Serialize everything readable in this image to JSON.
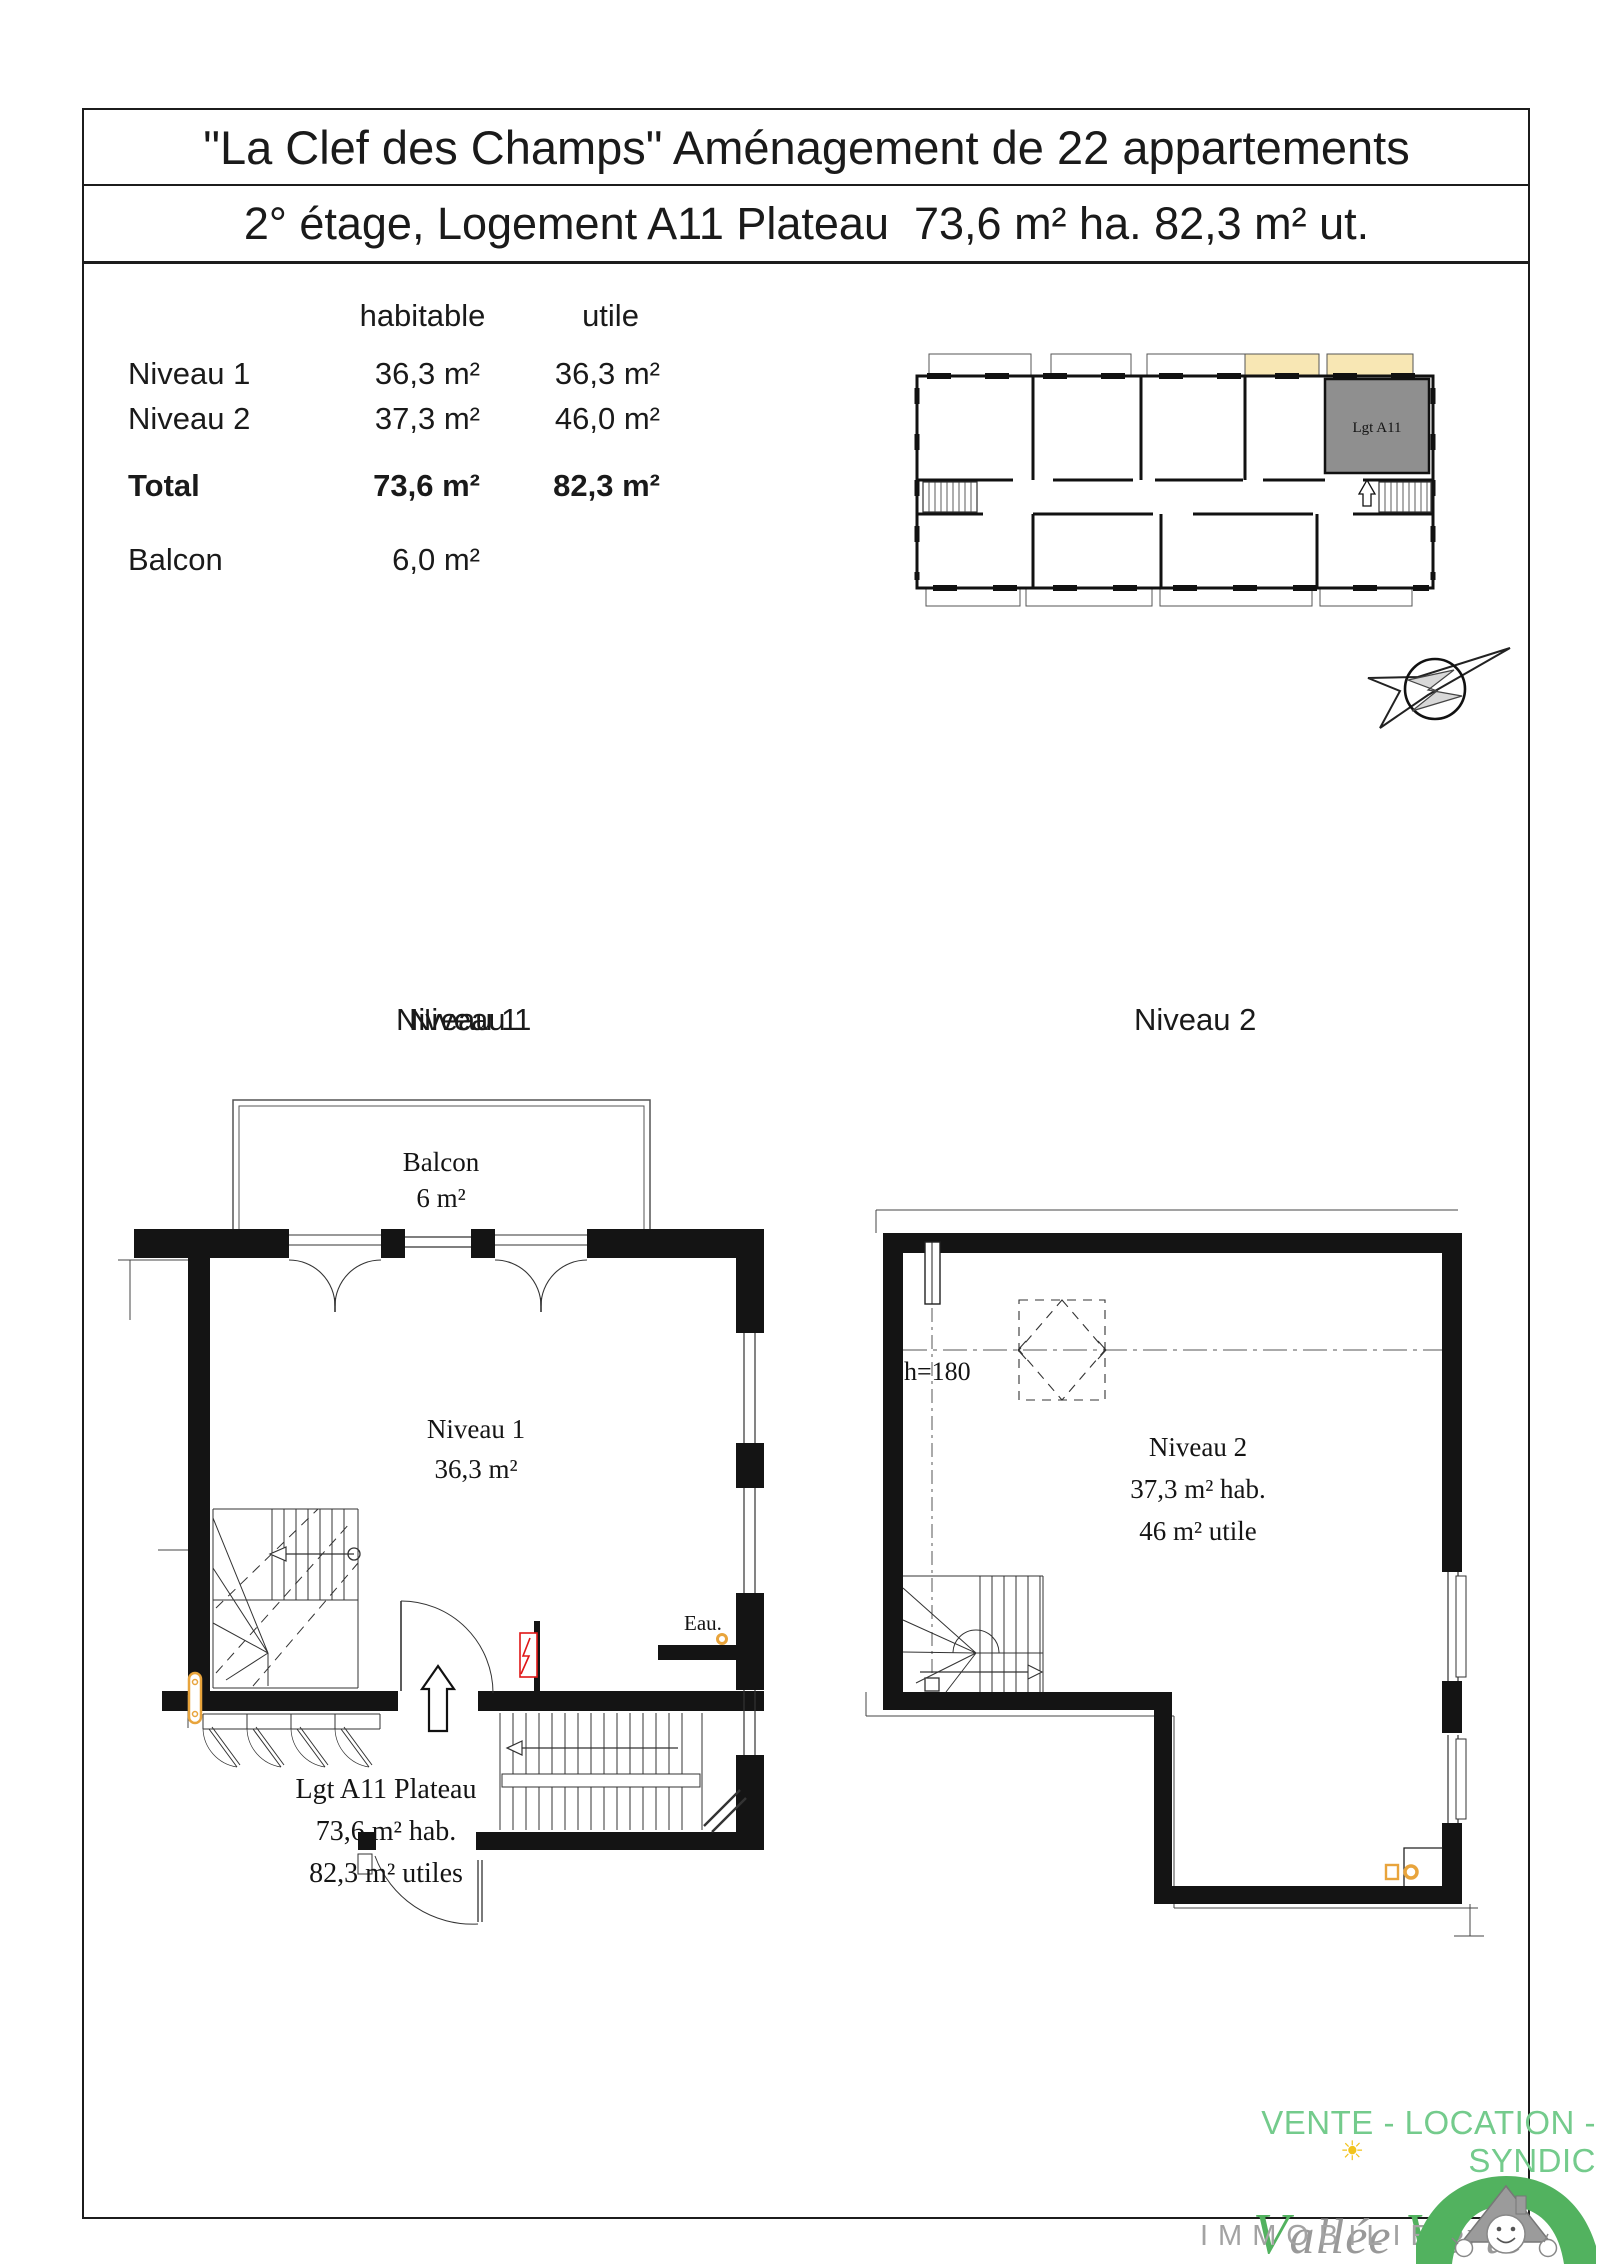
{
  "title": {
    "line1": "\"La Clef des Champs\" Aménagement de 22 appartements",
    "line2": "2° étage, Logement A11 Plateau  73,6 m² ha. 82,3 m² ut."
  },
  "area_table": {
    "header": {
      "habitable": "habitable",
      "utile": "utile"
    },
    "rows": [
      {
        "label": "Niveau 1",
        "habitable": "36,3 m²",
        "utile": "36,3 m²"
      },
      {
        "label": "Niveau 2",
        "habitable": "37,3 m²",
        "utile": "46,0 m²"
      }
    ],
    "total": {
      "label": "Total",
      "habitable": "73,6 m²",
      "utile": "82,3 m²"
    },
    "balcon": {
      "label": "Balcon",
      "value": "6,0 m²"
    }
  },
  "overview_plan": {
    "unit_label": "Lgt A11"
  },
  "section_headings": {
    "niveau1": "Niveau 1",
    "niveau2": "Niveau 2"
  },
  "plan_niveau1": {
    "balcon_label": "Balcon",
    "balcon_area": "6 m²",
    "room_label": "Niveau 1",
    "room_area": "36,3 m²",
    "water_label": "Eau.",
    "caption_line1": "Lgt A11 Plateau",
    "caption_line2": "73,6 m² hab.",
    "caption_line3": "82,3 m² utiles"
  },
  "plan_niveau2": {
    "height_label": "h=180",
    "room_label": "Niveau 2",
    "area_line1": "37,3 m² hab.",
    "area_line2": "46 m² utile"
  },
  "footer": {
    "tagline": "VENTE - LOCATION - SYNDIC",
    "brand_v1": "V",
    "brand_rest1": "allée ",
    "brand_v2": "V",
    "brand_rest2": "erte",
    "subtitle": "IMMOBILIER"
  },
  "colors": {
    "accent_green": "#74CB8C",
    "brand_green": "#52B25F",
    "logo_gray": "#999999",
    "balcony_cream": "#F8E7B4",
    "unit_gray": "#8F8F8F",
    "symbol_orange": "#E8A43C",
    "symbol_red": "#E01616",
    "water_blue": "#3B63C4"
  }
}
